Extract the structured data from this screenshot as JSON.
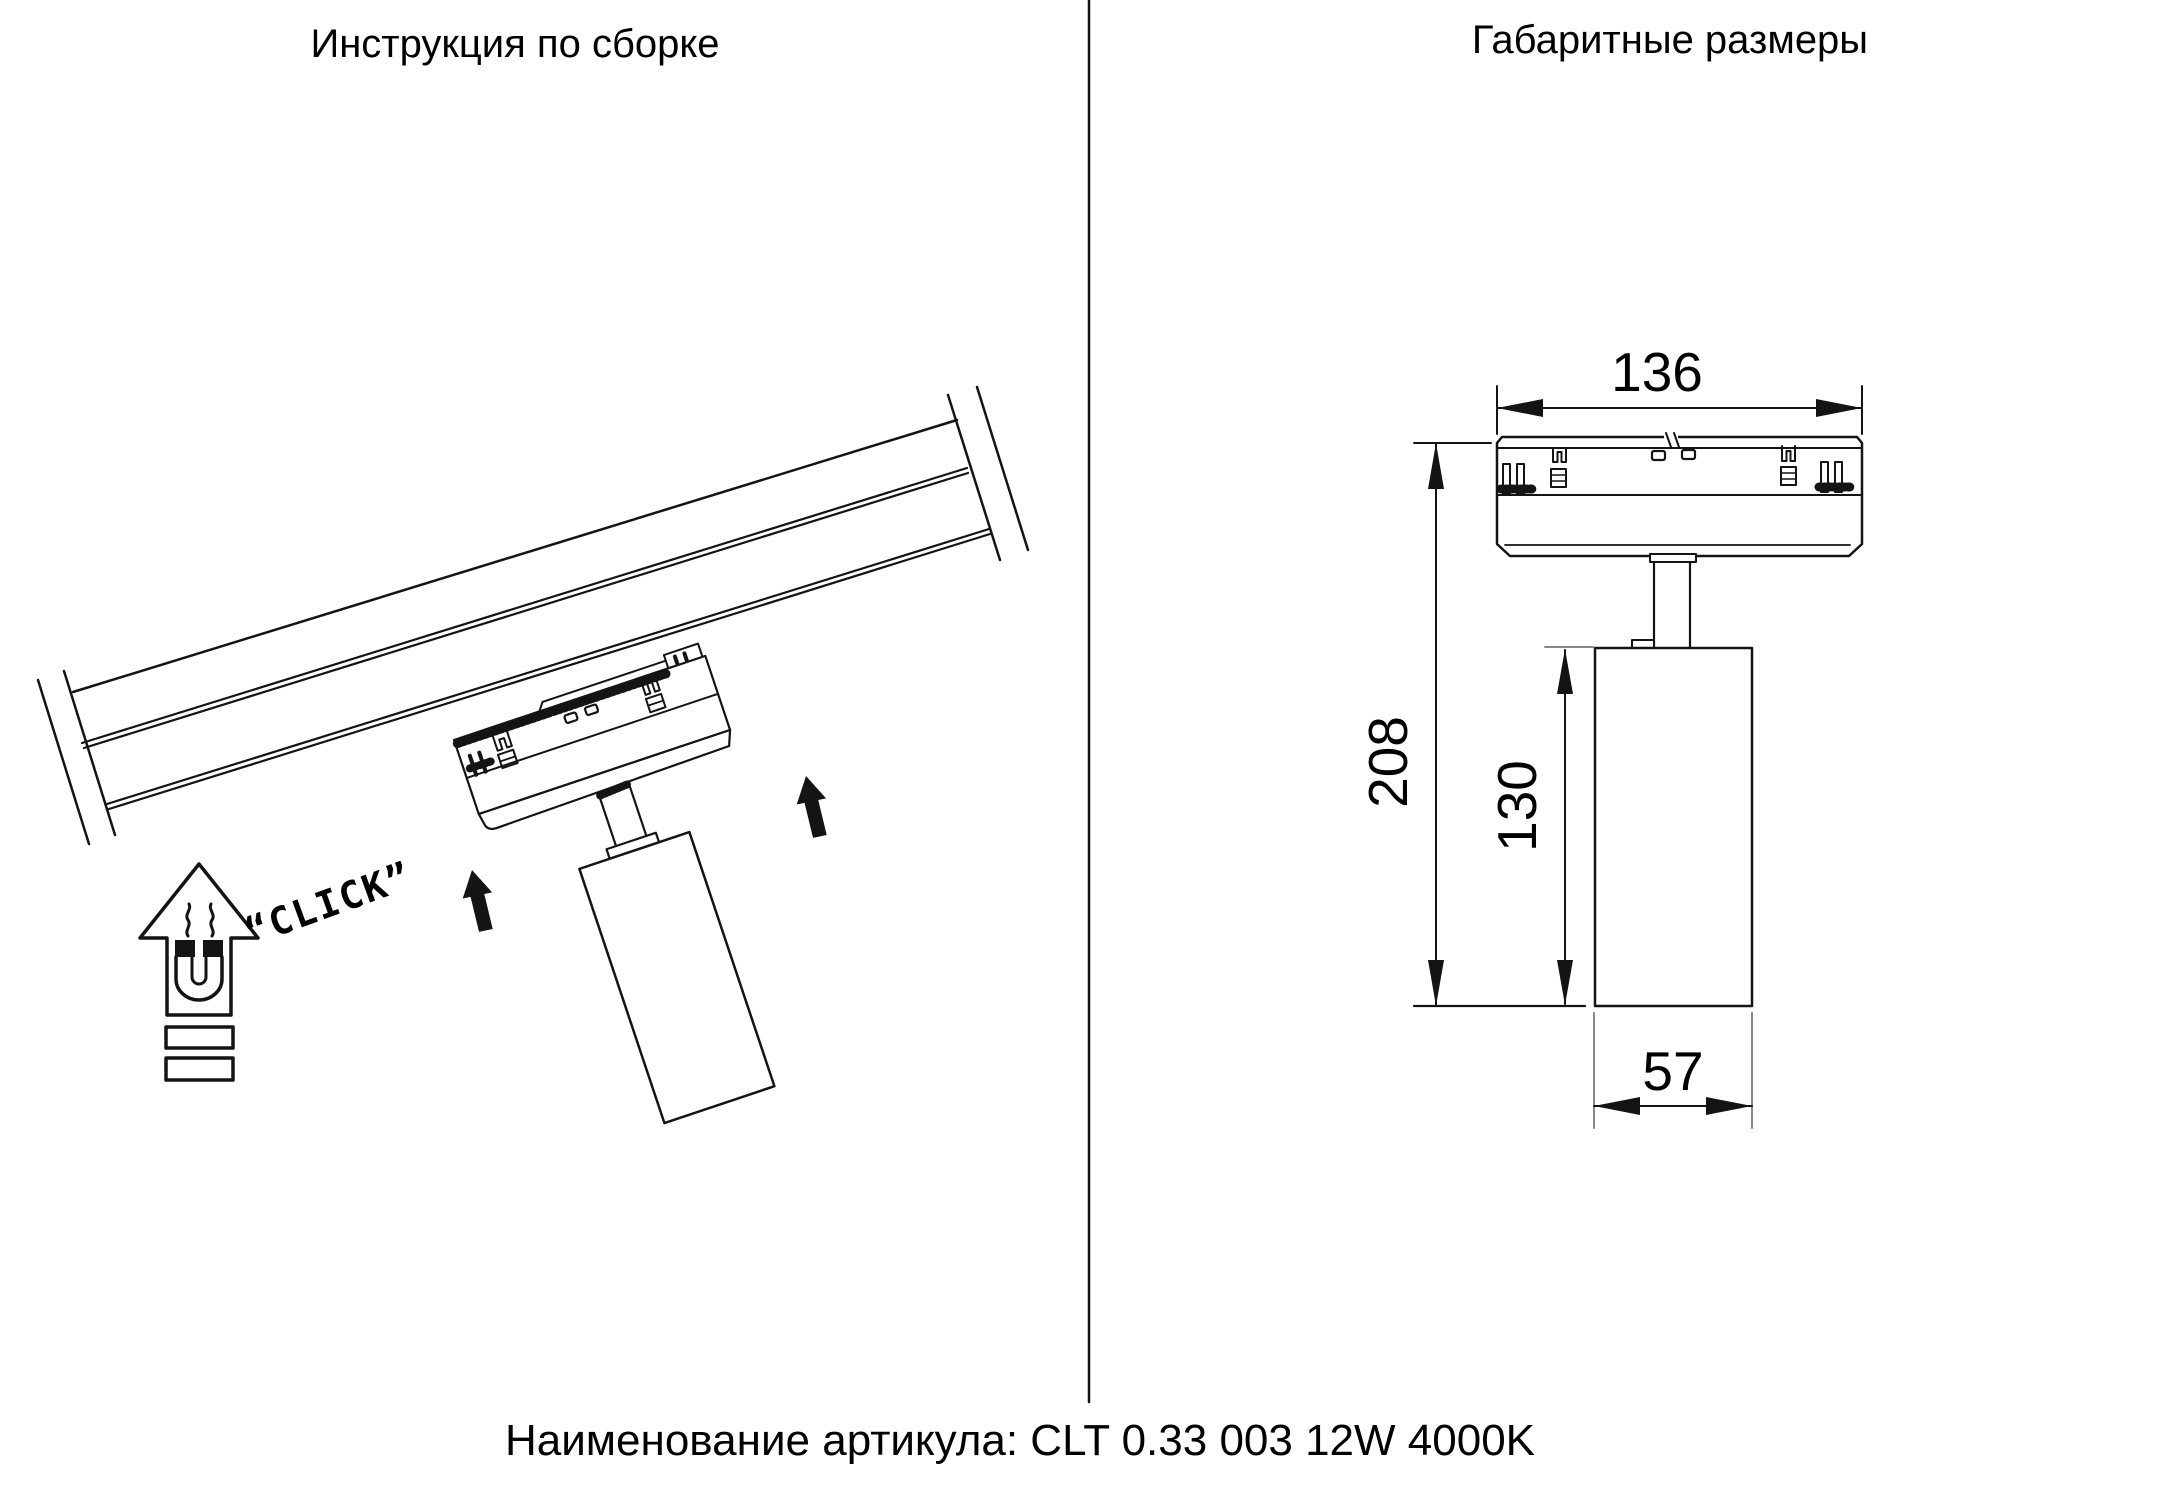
{
  "left_panel": {
    "title": "Инструкция по сборке",
    "click_label": "“CLICK”"
  },
  "right_panel": {
    "title": "Габаритные размеры",
    "dims": {
      "adapter_width": "136",
      "total_height": "208",
      "body_height": "130",
      "body_width": "57"
    }
  },
  "footer": {
    "article_label": "Наименование артикула: CLT 0.33 003 12W 4000K"
  },
  "colors": {
    "line": "#141414",
    "background": "#ffffff"
  }
}
